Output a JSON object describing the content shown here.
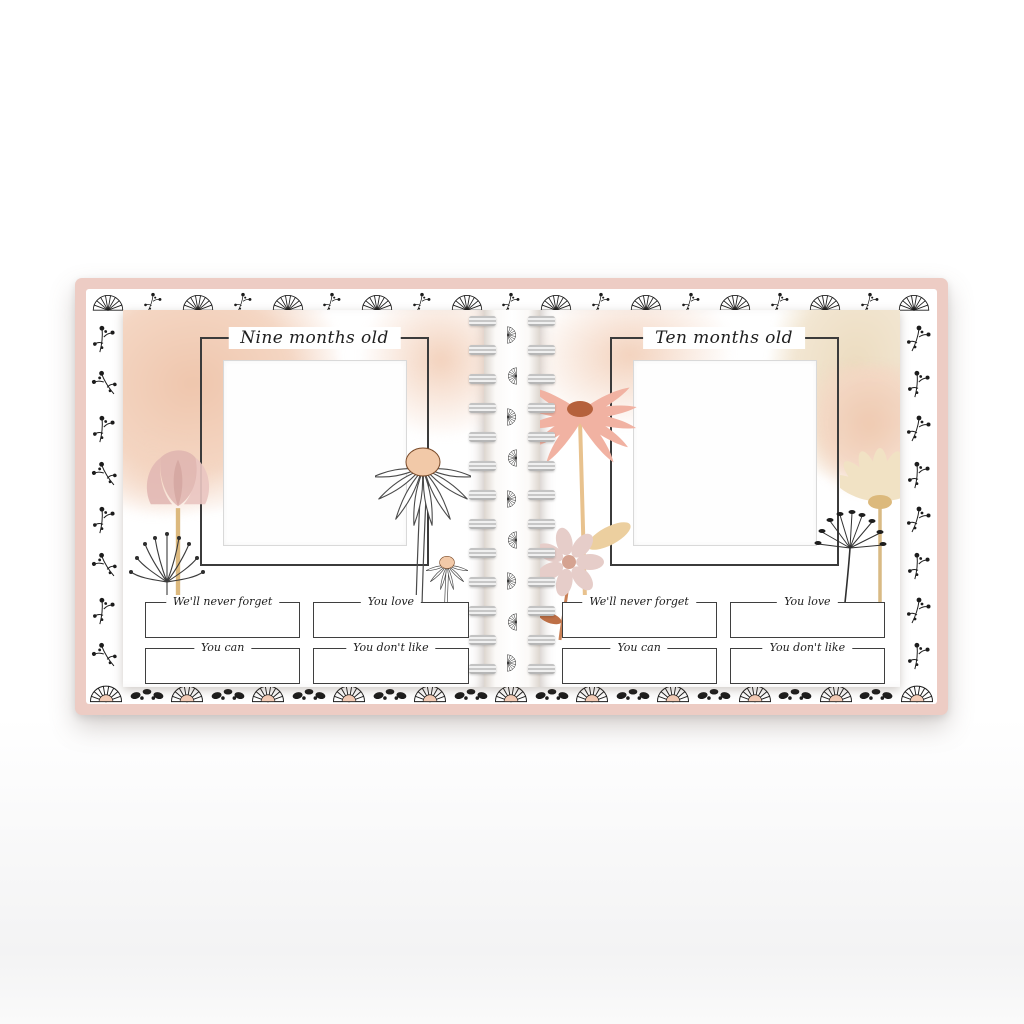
{
  "left_page": {
    "title": "Nine months old",
    "fields": [
      {
        "label": "We'll never forget"
      },
      {
        "label": "You love"
      },
      {
        "label": "You can"
      },
      {
        "label": "You don't like"
      }
    ]
  },
  "right_page": {
    "title": "Ten months old",
    "fields": [
      {
        "label": "We'll never forget"
      },
      {
        "label": "You love"
      },
      {
        "label": "You can"
      },
      {
        "label": "You don't like"
      }
    ]
  },
  "colors": {
    "cover_pink": "#edccc4",
    "line": "#3b3b3b",
    "pattern_ink": "#1d1d1d",
    "peach_wash": "#f2cdb5",
    "tan_wash": "#ecdcc2",
    "blush": "#e6c3be",
    "terracotta": "#bc6743",
    "stem_tan": "#ddbb80",
    "coil_gray": "#c7c7c7",
    "photo_border": "#d9d9d9"
  },
  "decor": {
    "motifs": [
      "fan",
      "floral-sprig",
      "seed-cluster"
    ]
  }
}
